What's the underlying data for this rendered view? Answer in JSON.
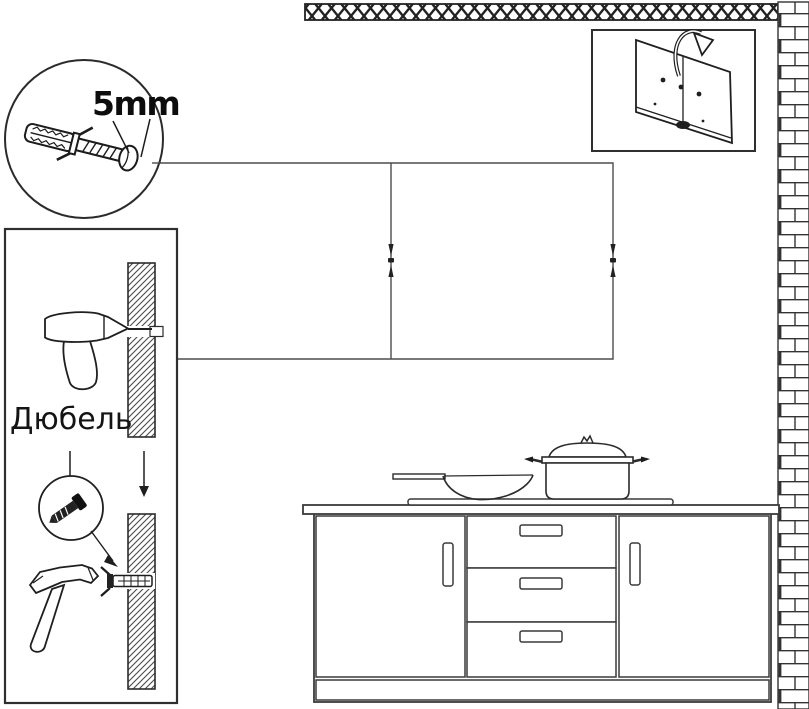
{
  "labels": {
    "size_label": "5mm",
    "dowel_label": "Дюбель"
  },
  "colors": {
    "line_dark": "#2b2b2b",
    "line_soft": "#4d4d4d",
    "hatch": "#4a4a4a",
    "background": "#ffffff"
  },
  "icons": {
    "detail_bubble": "wall-plug-with-screw-icon",
    "sidebar_steps": [
      "drill-icon",
      "hatched-wall-section",
      "screw-icon",
      "hammer-icon",
      "wall-plug-in-wall-icon",
      "down-arrow-icon"
    ],
    "inset": [
      "glass-panel-icon",
      "flip-over-arrow-icon",
      "mounting-hole-dots"
    ],
    "structures": [
      "ceiling-hatch-strip",
      "brick-wall-strip",
      "wall-cabinet-outline",
      "mounting-marks",
      "base-cabinet",
      "countertop",
      "cooktop"
    ],
    "cookware": [
      "wok-pan-icon",
      "stock-pot-icon"
    ]
  }
}
